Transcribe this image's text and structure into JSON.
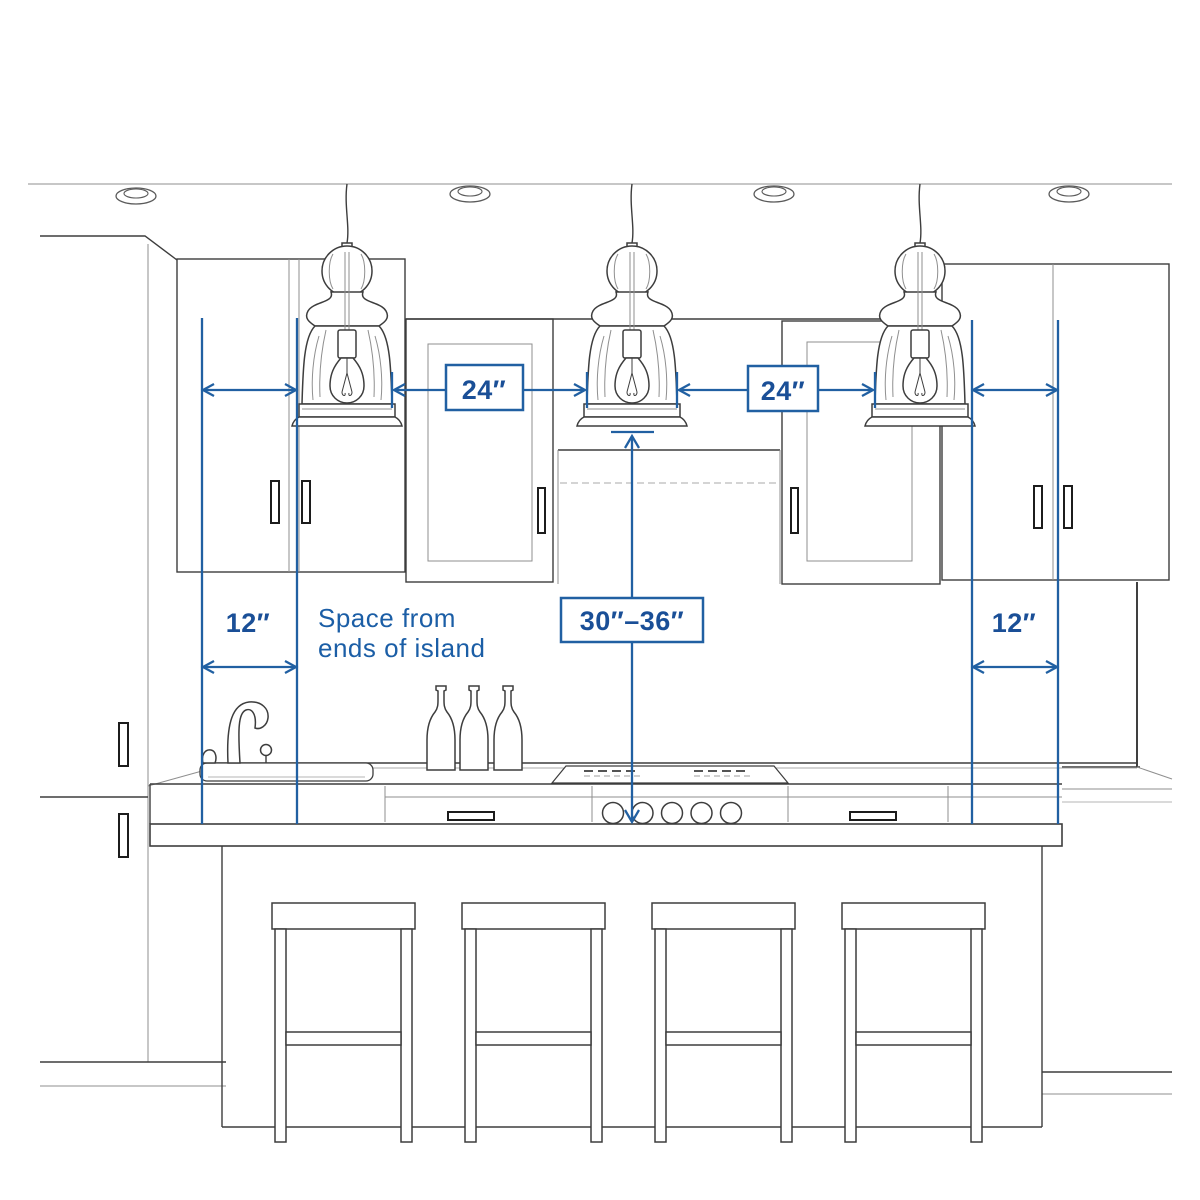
{
  "labels": {
    "left_space": "12″",
    "right_space": "12″",
    "gap_left": "24″",
    "gap_right": "24″",
    "hang_height": "30″–36″",
    "note_line1": "Space from",
    "note_line2": "ends of island"
  },
  "colors": {
    "dimension_blue": "#2160a2",
    "label_text_blue": "#1a4f97",
    "sketch_dark": "#3d3d3d",
    "sketch_light": "#8f8f8f"
  },
  "scene": {
    "pendant_lights": 3,
    "bar_stools": 4,
    "recessed_ceiling_lights": 4,
    "bottles_on_counter": 3
  }
}
